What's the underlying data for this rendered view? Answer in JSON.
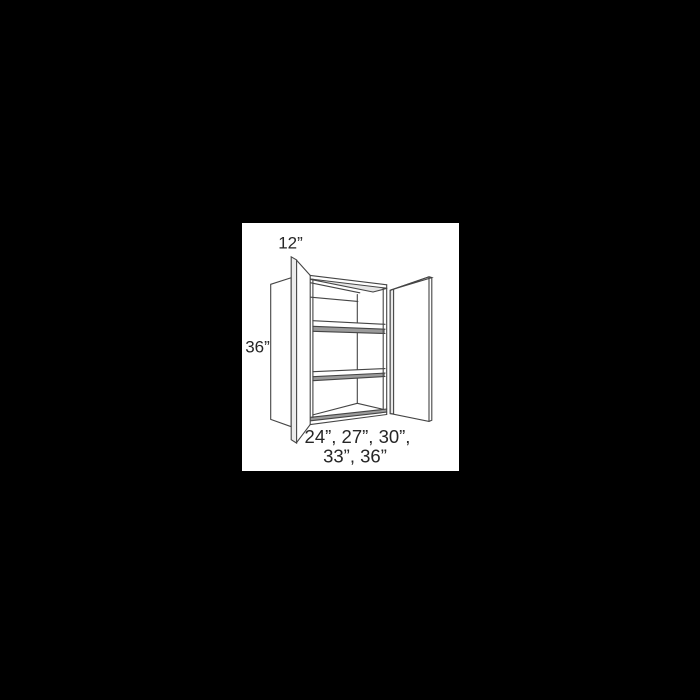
{
  "figure": {
    "type": "wall-cabinet-line-drawing",
    "background_color": "#000000",
    "panel_color": "#ffffff",
    "line_color": "#454545",
    "text_color": "#262626",
    "labels": {
      "depth": "12”",
      "height": "36”",
      "widths_line1": "24”, 27”, 30”,",
      "widths_line2": "33”, 36”"
    }
  }
}
